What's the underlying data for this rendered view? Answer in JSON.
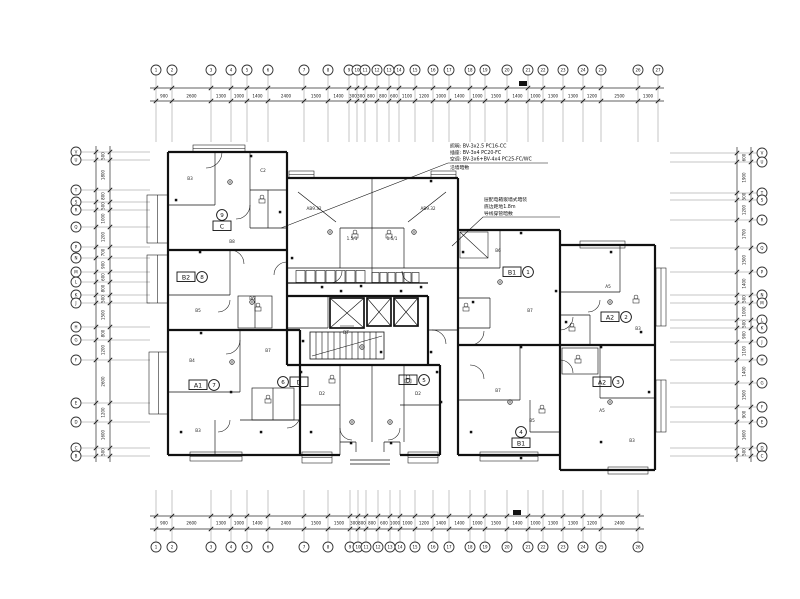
{
  "drawing": {
    "bg_color": "#ffffff",
    "line_color": "#111111",
    "annotations": {
      "block1": {
        "lines": [
          "照明: BV-3x2.5 PC16-CC",
          "插座: BV-3x4 PC20-FC",
          "空调: BV-3x6+BV-4x4 PC25-FC/WC",
          "沿墙暗敷"
        ]
      },
      "block2": {
        "lines": [
          "层配电箱嵌墙式暗装",
          "底边距地1.8m",
          "导线穿管暗敷"
        ]
      }
    },
    "units": [
      {
        "box": "C",
        "circle": "9",
        "x": 222,
        "y": 226,
        "layout": "v"
      },
      {
        "box": "B2",
        "circle": "8",
        "x": 186,
        "y": 277,
        "layout": "h",
        "order": "bc"
      },
      {
        "box": "A1",
        "circle": "7",
        "x": 198,
        "y": 385,
        "layout": "h",
        "order": "bc"
      },
      {
        "box": "D",
        "circle": "6",
        "x": 299,
        "y": 382,
        "layout": "h",
        "order": "cb"
      },
      {
        "box": "D",
        "circle": "5",
        "x": 408,
        "y": 380,
        "layout": "h",
        "order": "bc"
      },
      {
        "box": "B1",
        "circle": "1",
        "x": 512,
        "y": 272,
        "layout": "h",
        "order": "bc"
      },
      {
        "box": "A2",
        "circle": "2",
        "x": 610,
        "y": 317,
        "layout": "h",
        "order": "bc"
      },
      {
        "box": "A2",
        "circle": "3",
        "x": 602,
        "y": 382,
        "layout": "h",
        "order": "bc"
      },
      {
        "box": "B1",
        "circle": "4",
        "x": 521,
        "y": 443,
        "layout": "v"
      }
    ],
    "rooms": [
      {
        "t": "B3",
        "x": 190,
        "y": 180
      },
      {
        "t": "C2",
        "x": 263,
        "y": 172
      },
      {
        "t": "B8",
        "x": 232,
        "y": 243
      },
      {
        "t": "AB9.32",
        "x": 314,
        "y": 210
      },
      {
        "t": "AB9.32",
        "x": 428,
        "y": 210
      },
      {
        "t": "1.5/1",
        "x": 352,
        "y": 240
      },
      {
        "t": "1.5/1",
        "x": 392,
        "y": 240
      },
      {
        "t": "B5",
        "x": 198,
        "y": 312
      },
      {
        "t": "B6",
        "x": 252,
        "y": 300
      },
      {
        "t": "B4",
        "x": 192,
        "y": 362
      },
      {
        "t": "B7",
        "x": 268,
        "y": 352
      },
      {
        "t": "B3",
        "x": 198,
        "y": 432
      },
      {
        "t": "D2",
        "x": 322,
        "y": 395
      },
      {
        "t": "D2",
        "x": 418,
        "y": 395
      },
      {
        "t": "B6",
        "x": 498,
        "y": 252
      },
      {
        "t": "B7",
        "x": 530,
        "y": 312
      },
      {
        "t": "A5",
        "x": 608,
        "y": 288
      },
      {
        "t": "B3",
        "x": 638,
        "y": 330
      },
      {
        "t": "B7",
        "x": 498,
        "y": 392
      },
      {
        "t": "B5",
        "x": 532,
        "y": 422
      },
      {
        "t": "A5",
        "x": 602,
        "y": 412
      },
      {
        "t": "B3",
        "x": 632,
        "y": 442
      },
      {
        "t": "DT",
        "x": 346,
        "y": 334
      }
    ],
    "axes": {
      "top": {
        "x": [
          156,
          172,
          211,
          231,
          247,
          268,
          304,
          328,
          349,
          357,
          365,
          377,
          389,
          399,
          415,
          433,
          449,
          470,
          485,
          507,
          528,
          543,
          563,
          583,
          601,
          638,
          658
        ],
        "labels": [
          "1",
          "2",
          "3",
          "4",
          "5",
          "6",
          "7",
          "8",
          "9",
          "10",
          "11",
          "12",
          "13",
          "14",
          "15",
          "16",
          "17",
          "18",
          "19",
          "20",
          "21",
          "22",
          "23",
          "24",
          "25",
          "26",
          "27"
        ],
        "dims": [
          "900",
          "2600",
          "1300",
          "1000",
          "1400",
          "2400",
          "1500",
          "1400",
          "300",
          "300",
          "800",
          "800",
          "600",
          "1100",
          "1200",
          "1000",
          "1400",
          "1000",
          "1500",
          "1400",
          "1000",
          "1300",
          "1300",
          "1200",
          "2500",
          "1300"
        ]
      },
      "bottom": {
        "x": [
          156,
          172,
          211,
          231,
          247,
          268,
          304,
          328,
          350,
          358,
          366,
          378,
          390,
          400,
          415,
          433,
          449,
          470,
          485,
          507,
          528,
          543,
          563,
          583,
          601,
          638
        ],
        "labels": [
          "1",
          "2",
          "3",
          "4",
          "5",
          "6",
          "7",
          "8",
          "9",
          "10",
          "11",
          "12",
          "13",
          "14",
          "15",
          "16",
          "17",
          "18",
          "19",
          "20",
          "21",
          "22",
          "23",
          "24",
          "25",
          "26"
        ],
        "dims": [
          "900",
          "2600",
          "1300",
          "1000",
          "1400",
          "2400",
          "1500",
          "1500",
          "300",
          "800",
          "800",
          "600",
          "1000",
          "1000",
          "1200",
          "1400",
          "1400",
          "1000",
          "1500",
          "1400",
          "1000",
          "1300",
          "1300",
          "1200",
          "2400"
        ]
      },
      "left": {
        "y": [
          152,
          160,
          190,
          202,
          210,
          227,
          247,
          258,
          272,
          282,
          295,
          303,
          327,
          340,
          360,
          403,
          422,
          448,
          456
        ],
        "labels": [
          "V",
          "U",
          "T",
          "S",
          "R",
          "Q",
          "P",
          "N",
          "M",
          "L",
          "K",
          "J",
          "H",
          "G",
          "F",
          "E",
          "D",
          "C",
          "B"
        ],
        "dims": [
          "500",
          "1800",
          "800",
          "500",
          "1000",
          "1200",
          "700",
          "900",
          "600",
          "800",
          "500",
          "1500",
          "800",
          "1200",
          "2600",
          "1200",
          "1600",
          "500"
        ]
      },
      "right": {
        "y": [
          153,
          162,
          193,
          200,
          220,
          248,
          272,
          295,
          303,
          320,
          328,
          342,
          360,
          383,
          407,
          422,
          448,
          456
        ],
        "labels": [
          "V",
          "U",
          "T",
          "S",
          "R",
          "Q",
          "P",
          "N",
          "M",
          "L",
          "K",
          "J",
          "H",
          "G",
          "F",
          "E",
          "D",
          "C"
        ],
        "dims": [
          "600",
          "1900",
          "500",
          "1200",
          "1700",
          "1500",
          "1400",
          "500",
          "1000",
          "500",
          "900",
          "1100",
          "1400",
          "1500",
          "900",
          "1600",
          "500"
        ]
      }
    }
  }
}
